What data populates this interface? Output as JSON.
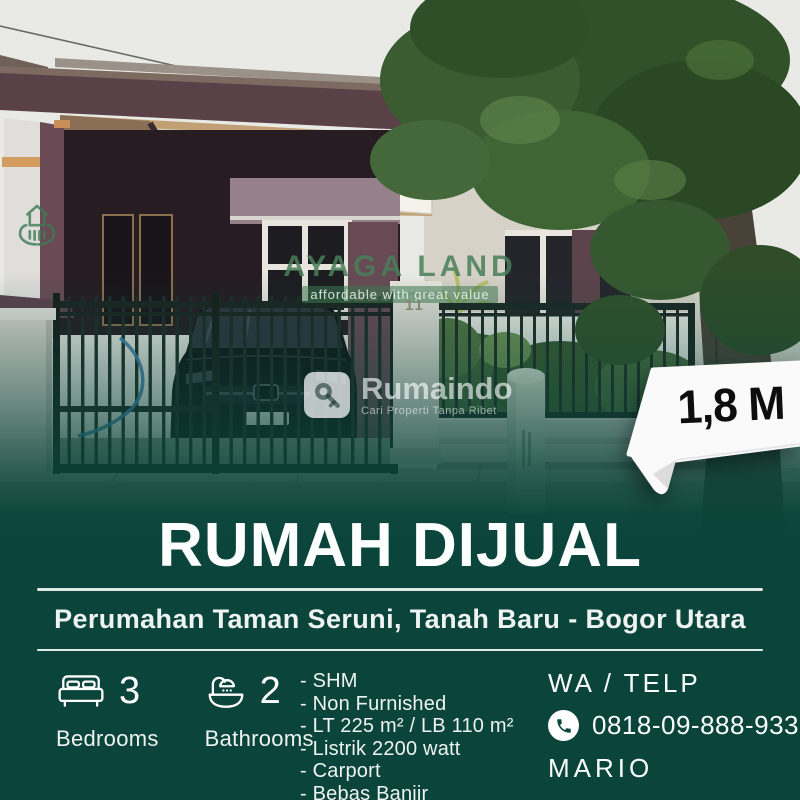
{
  "branding": {
    "agency_logo_text": "AYAGA LAND",
    "agency_tagline": "affordable with great value",
    "platform_name": "Rumaindo",
    "platform_tagline": "Cari Properti Tanpa Ribet"
  },
  "photo": {
    "house_number": "11"
  },
  "price_tag": {
    "price": "1,8 M"
  },
  "listing": {
    "title": "RUMAH DIJUAL",
    "location": "Perumahan Taman Seruni, Tanah Baru - Bogor Utara",
    "stats": [
      {
        "value": "3",
        "label": "Bedrooms",
        "icon": "bed-icon"
      },
      {
        "value": "2",
        "label": "Bathrooms",
        "icon": "bath-icon"
      }
    ],
    "features": [
      "- SHM",
      "- Non Furnished",
      "- LT 225 m² / LB 110 m²",
      "- Listrik 2200 watt",
      "- Carport",
      "- Bebas Banjir"
    ],
    "contact": {
      "heading": "WA / TELP",
      "phone": "0818-09-888-933",
      "name": "MARIO"
    }
  },
  "colors": {
    "panel": "#0a443a",
    "accent_green": "#3e7d55",
    "tag_bg": "#fafafa",
    "tag_text": "#0e0e0e"
  }
}
